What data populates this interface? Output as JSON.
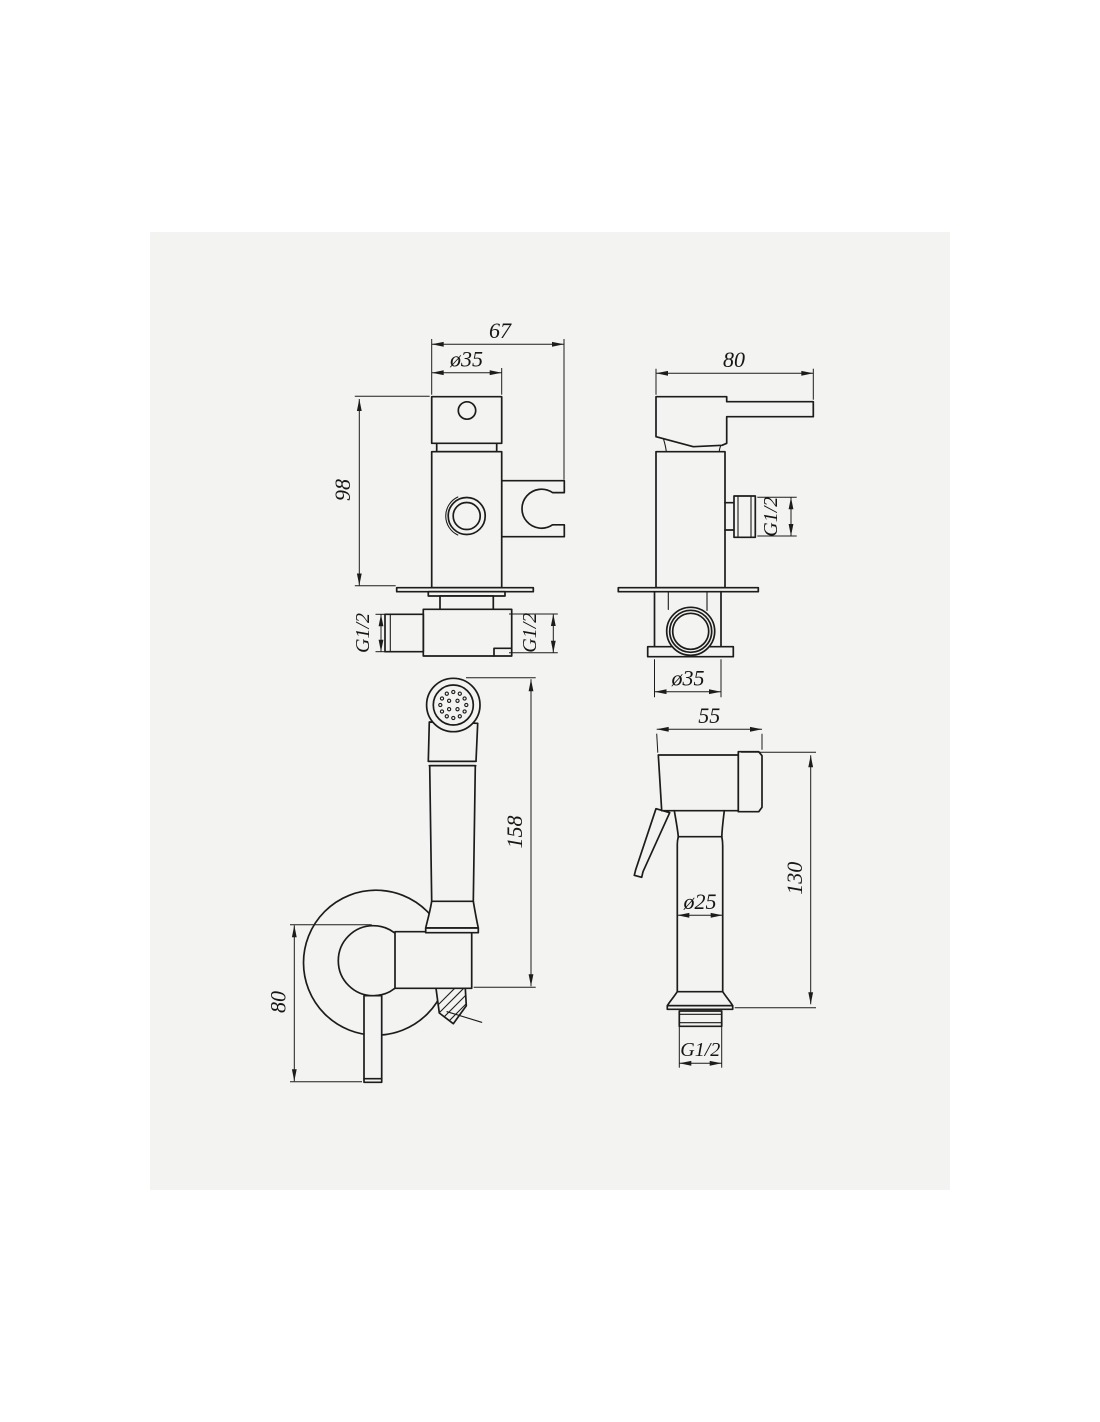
{
  "drawing": {
    "kind": "bidet shower set technical drawing",
    "colors": {
      "page_bg": "#ffffff",
      "sheet_bg": "#f3f3f1",
      "line": "#1c1c1c"
    },
    "views": {
      "valve_front": {
        "width": "67",
        "top_diameter": "ø35",
        "height": "98",
        "thread_left": "G1/2",
        "thread_right": "G1/2"
      },
      "valve_side": {
        "depth": "80",
        "side_thread": "G1/2",
        "base_diameter": "ø35"
      },
      "sprayer_front": {
        "total_height": "158",
        "lever_height": "80"
      },
      "sprayer_side": {
        "head_length": "55",
        "body_diameter": "ø25",
        "height": "130",
        "bottom_thread": "G1/2"
      }
    }
  }
}
